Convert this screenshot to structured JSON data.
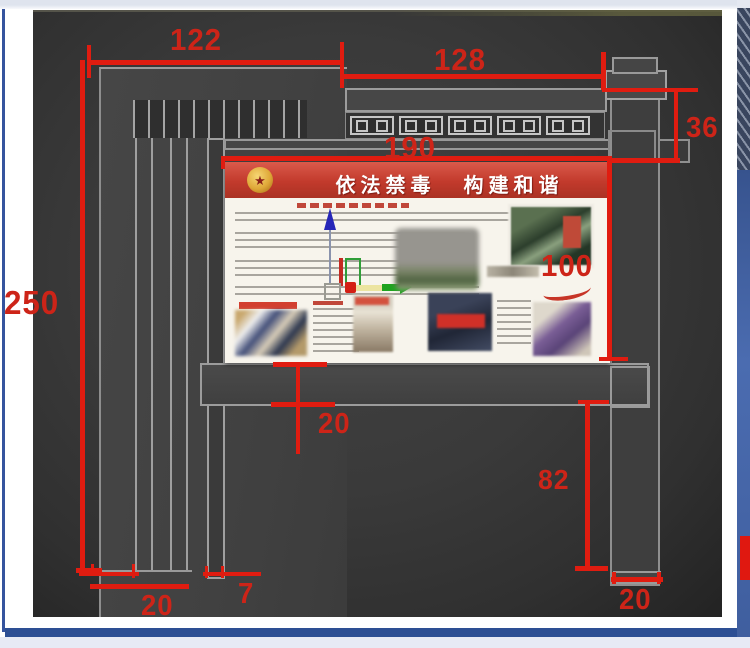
{
  "dims": {
    "width_left": "122",
    "width_right": "128",
    "cornice_height": "36",
    "board_width": "190",
    "board_height": "100",
    "total_height": "250",
    "shelf_thickness": "20",
    "leg_height": "82",
    "foot_right_width": "20",
    "foot_left_width": "20",
    "slat_width": "7"
  },
  "poster": {
    "banner_left": "依法禁毒",
    "banner_right": "构建和谐",
    "emblem_icon": "national-emblem-icon"
  },
  "colors": {
    "dimension_red": "#e01c10",
    "banner_red": "#c23a2c",
    "canvas_gray": "#3a3a3a",
    "frame_blue": "#2d4f94",
    "lattice_gray": "#c6c6c6"
  }
}
